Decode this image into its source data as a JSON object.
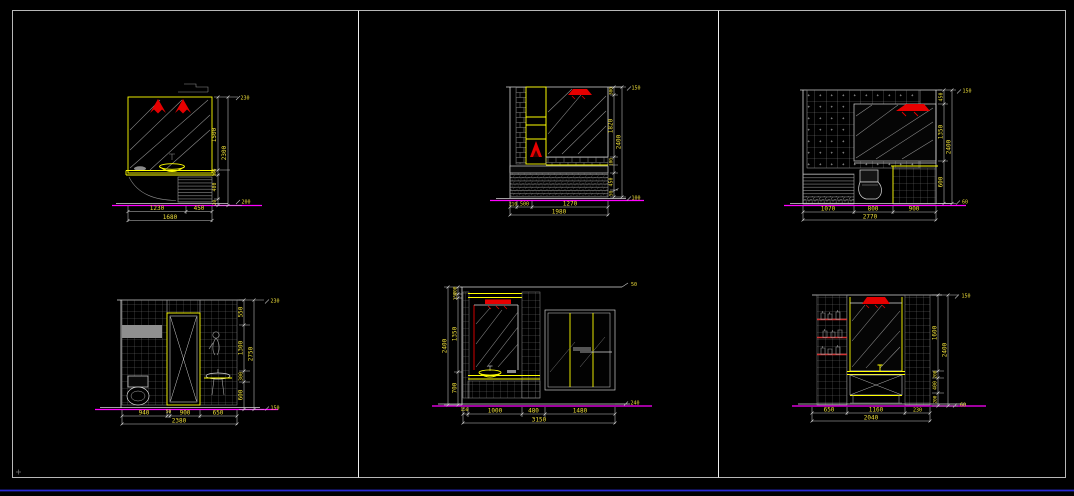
{
  "colors": {
    "background": "#000000",
    "frame": "#b8b8b8",
    "divider": "#f0f0f0",
    "line_white": "#d8d8d8",
    "hatch_gray": "#8f8f8f",
    "accent_yellow": "#ffff00",
    "accent_red": "#e60000",
    "baseline_magenta": "#ff00ff",
    "dim_text": "#efdf3a",
    "footer_blue": "#2a2ad4"
  },
  "panels": {
    "top_left": {
      "dims_bottom": [
        "1230",
        "450"
      ],
      "total_bottom": "1680",
      "dims_right": [
        "1500",
        "150",
        "400",
        "20"
      ],
      "total_right": "2300",
      "note_top": "230",
      "note_bottom": "200"
    },
    "top_middle": {
      "dims_bottom": [
        "210",
        "500",
        "1270"
      ],
      "total_bottom": "1980",
      "dims_right": [
        "300",
        "1820",
        "100",
        "450",
        "50"
      ],
      "total_right": "2400",
      "note_top": "150",
      "note_bottom": "100"
    },
    "top_right": {
      "dims_bottom": [
        "1070",
        "800",
        "900"
      ],
      "total_bottom": "2770",
      "dims_right": [
        "450",
        "1350",
        "600"
      ],
      "total_right": "2400",
      "note_top": "150",
      "note_bottom": "60"
    },
    "bottom_left": {
      "dims_bottom": [
        "940",
        "50",
        "900",
        "650"
      ],
      "total_bottom": "2380",
      "dims_right": [
        "550",
        "1300",
        "300",
        "600"
      ],
      "total_right": "2750",
      "note_top": "230",
      "note_bottom": "150"
    },
    "bottom_middle": {
      "dims_bottom": [
        "150",
        "1000",
        "480",
        "1480"
      ],
      "total_bottom": "3150",
      "dims_left": [
        "200",
        "150",
        "1350",
        "700"
      ],
      "total_left": "2400",
      "note_top": "50",
      "note_bottom": "240"
    },
    "bottom_right": {
      "dims_bottom": [
        "650",
        "1160",
        "230"
      ],
      "total_bottom": "2040",
      "dims_right": [
        "1600",
        "200",
        "400",
        "200"
      ],
      "total_right": "2400",
      "note_top": "150",
      "note_bottom": "60"
    }
  }
}
